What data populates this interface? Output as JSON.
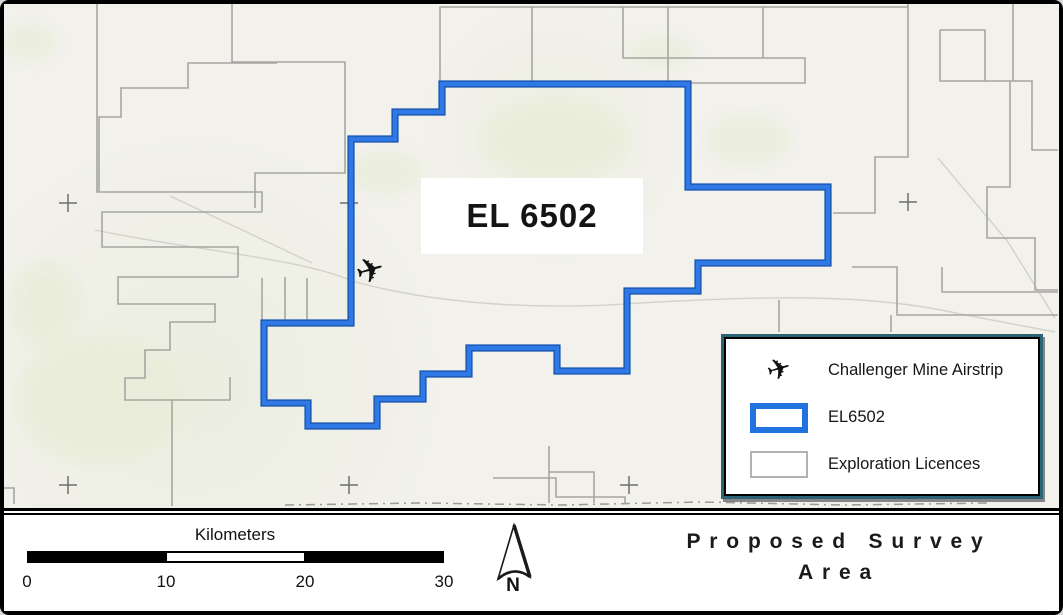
{
  "map": {
    "label_el6502": "EL 6502",
    "airstrip_icon": "✈",
    "colors": {
      "background": "#f2f1ec",
      "el6502_stroke": "#2e79e6",
      "licence_stroke": "#a6a6a2",
      "legend_border": "#2a6276",
      "scale_segments": [
        "#000000",
        "#ffffff",
        "#000000"
      ]
    },
    "geometry": {
      "el6502_path": "M442,84 L688,84 L688,187 L828,187 L828,263 L698,263 L698,291 L627,291 L627,371 L557,371 L557,348 L469,348 L469,374 L423,374 L423,399 L377,399 L377,426 L308,426 L308,403 L264,403 L264,323 L351,323 L351,139 L395,139 L395,112 L442,112 Z",
      "licence_paths": [
        "M97,4 L97,192 L262,192 L262,212",
        "M232,4 L232,62 L345,62 L345,173 L255,173 L255,208",
        "M277,63 L188,63 L188,88 L121,88 L121,117 L99,117 L99,192",
        "M262,212 L102,212 L102,247 L238,247 L238,277",
        "M238,277 L118,277 L118,304 L215,304 L215,322 L170,322 L170,350 L145,350 L145,378 L125,378 L125,400 L230,400 L230,377",
        "M172,400 L172,506",
        "M440,83 L440,7 L763,7 L763,58 L623,58 L623,7",
        "M532,7 L532,83",
        "M668,7 L668,83 L805,83 L805,58 L763,58",
        "M763,7 L908,7",
        "M908,4 L908,157 L875,157 L875,213 L833,213",
        "M940,30 L985,30 L985,81 L940,81 L940,30",
        "M1013,4 L1013,81",
        "M985,81 L1032,81 L1032,150 L1058,150",
        "M1010,81 L1010,187 L987,187 L987,238 L1035,238 L1035,290 L1058,290",
        "M852,267 L897,267 L897,315 L1058,315",
        "M942,267 L942,292 L1058,292",
        "M779,300 L779,332",
        "M891,315 L891,332",
        "M549,446 L549,503",
        "M549,472 L594,472 L594,503",
        "M493,478 L556,478 L556,497 L625,497 L625,504",
        "M262,278 L262,321",
        "M285,277 L285,321",
        "M307,278 L307,321",
        "M4,488 L14,488 L14,504"
      ],
      "roads": [
        "M95,230 C190,250 300,258 352,281 C420,300 520,312 640,303 C760,296 870,293 960,314 L1055,332",
        "M170,196 L255,236 L312,263",
        "M938,158 L1008,242 L1055,318"
      ],
      "dashed_track": "M285,505 L420,503 L560,505 L700,502 L845,505 L990,503",
      "graticule_marks": [
        [
          68,
          203
        ],
        [
          349,
          203
        ],
        [
          908,
          202
        ],
        [
          68,
          485
        ],
        [
          349,
          485
        ],
        [
          629,
          485
        ]
      ],
      "green_patches": [
        [
          100,
          400,
          85,
          65
        ],
        [
          45,
          305,
          35,
          45
        ],
        [
          555,
          140,
          75,
          42
        ],
        [
          748,
          140,
          42,
          26
        ],
        [
          662,
          52,
          32,
          16
        ],
        [
          30,
          42,
          26,
          18
        ],
        [
          385,
          172,
          38,
          22
        ]
      ]
    }
  },
  "legend": {
    "items": [
      {
        "icon": "✈",
        "label": "Challenger Mine Airstrip"
      },
      {
        "label": "EL6502"
      },
      {
        "label": "Exploration Licences"
      }
    ]
  },
  "scale_bar": {
    "title": "Kilometers",
    "ticks": [
      "0",
      "10",
      "20",
      "30"
    ]
  },
  "north_arrow": {
    "label": "N"
  },
  "title_block": {
    "line1": "Proposed Survey",
    "line2": "Area"
  }
}
